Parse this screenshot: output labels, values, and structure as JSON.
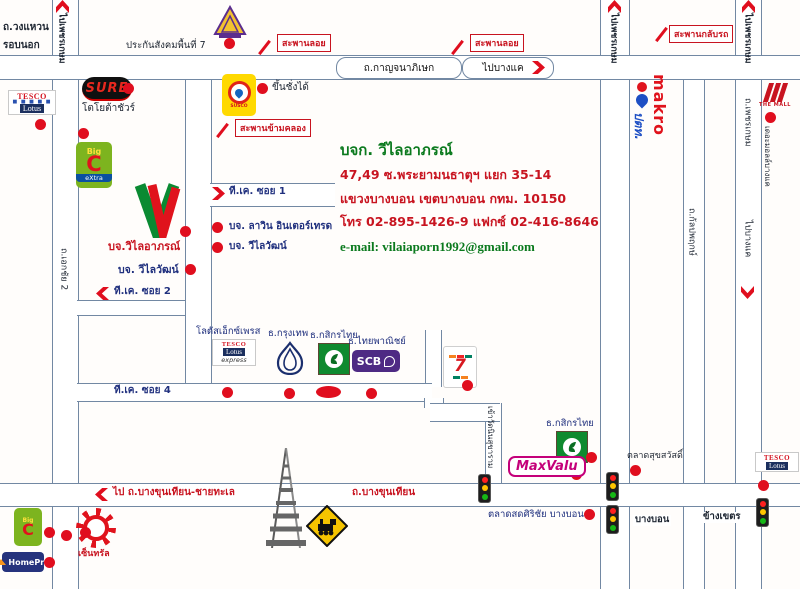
{
  "info": {
    "company": "บจก. วีไลอาภรณ์",
    "address1": "47,49 ซ.พระยามนธาตุฯ แยก 35-14",
    "address2": "แขวงบางบอน เขตบางบอน กทม. 10150",
    "phone": "โทร 02-895-1426-9 แฟกซ์ 02-416-8646",
    "email": "e-mail: vilaiaporn1992@gmail.com"
  },
  "roads": {
    "ring1": "ถ.วงแหวน",
    "ring2": "รอบนอก",
    "kanchanaphisek": "ถ.กาญจนาภิเษก",
    "to_bangkhae": "ไปบางแค",
    "to_phetkasem": "ไปเพชรเกษม",
    "phetkasem": "ถ.เพชรเกษม",
    "kanlapaphruek": "ถ.กัลปพฤกษ์",
    "ekachai2": "ถ.เอกชัย 2",
    "bangbon": "บางบอน",
    "khang_khet": "ข้างเขตร",
    "bangkhunthian": "ถ.บางขุนเทียน",
    "to_bkt_seaside": "ไป ถ.บางขุนเทียน-ชายทะเล",
    "wat_road": "เข้าวัดนินสุขาราม",
    "tk_soi1": "ที.เค. ซอย 1",
    "tk_soi2": "ที.เค. ซอย 2",
    "tk_soi4": "ที.เค. ซอย 4",
    "mall_side": "เดอะมอลล์บางแค"
  },
  "bridges": {
    "overpass": "สะพานลอย",
    "uturn": "สะพานกลับรถ",
    "canal": "สะพานข้ามคลอง"
  },
  "places": {
    "sso": "ประกันสังคมพื้นที่ 7",
    "toyota_sure": "โตโยต้าชัวร์",
    "weigh_note": "ขึ้นชั่งได้",
    "company_v": "บจ.วิไลอาภรณ์",
    "wilaiwat": "บจ. วีไลวัฒน์",
    "lawin": "บจ. ลาวิน อินเตอร์เทรด",
    "lotus_express": "โลตัสเอ็กซ์เพรส",
    "bangkok_bank": "ธ.กรุงเทพ",
    "kasikorn": "ธ.กสิกรไทย",
    "scb_bank": "ธ.ไทยพาณิชย์",
    "talad_suk": "ตลาดสุขสวัสดิ์",
    "talad_sirichai": "ตลาดสดศิริชัย บางบอน",
    "central": "เซ็นทรัล"
  },
  "brands": {
    "tesco": "TESCO",
    "lotus": "Lotus",
    "express": "express",
    "sure": "SURE",
    "susco": "SUSCO",
    "big": "Big",
    "c": "C",
    "extra": "eXtra",
    "scb": "SCB",
    "seven": "7",
    "maxvalu": "MaxValu",
    "makro": "makro",
    "ptt": "ปตท.",
    "homepro": "HomePro",
    "themall": "THE MALL"
  },
  "colors": {
    "route_red": "#e00e1e",
    "label_red": "#c81420",
    "navy": "#20307e",
    "green": "#0b7a1e",
    "road_line": "#7288a3"
  }
}
